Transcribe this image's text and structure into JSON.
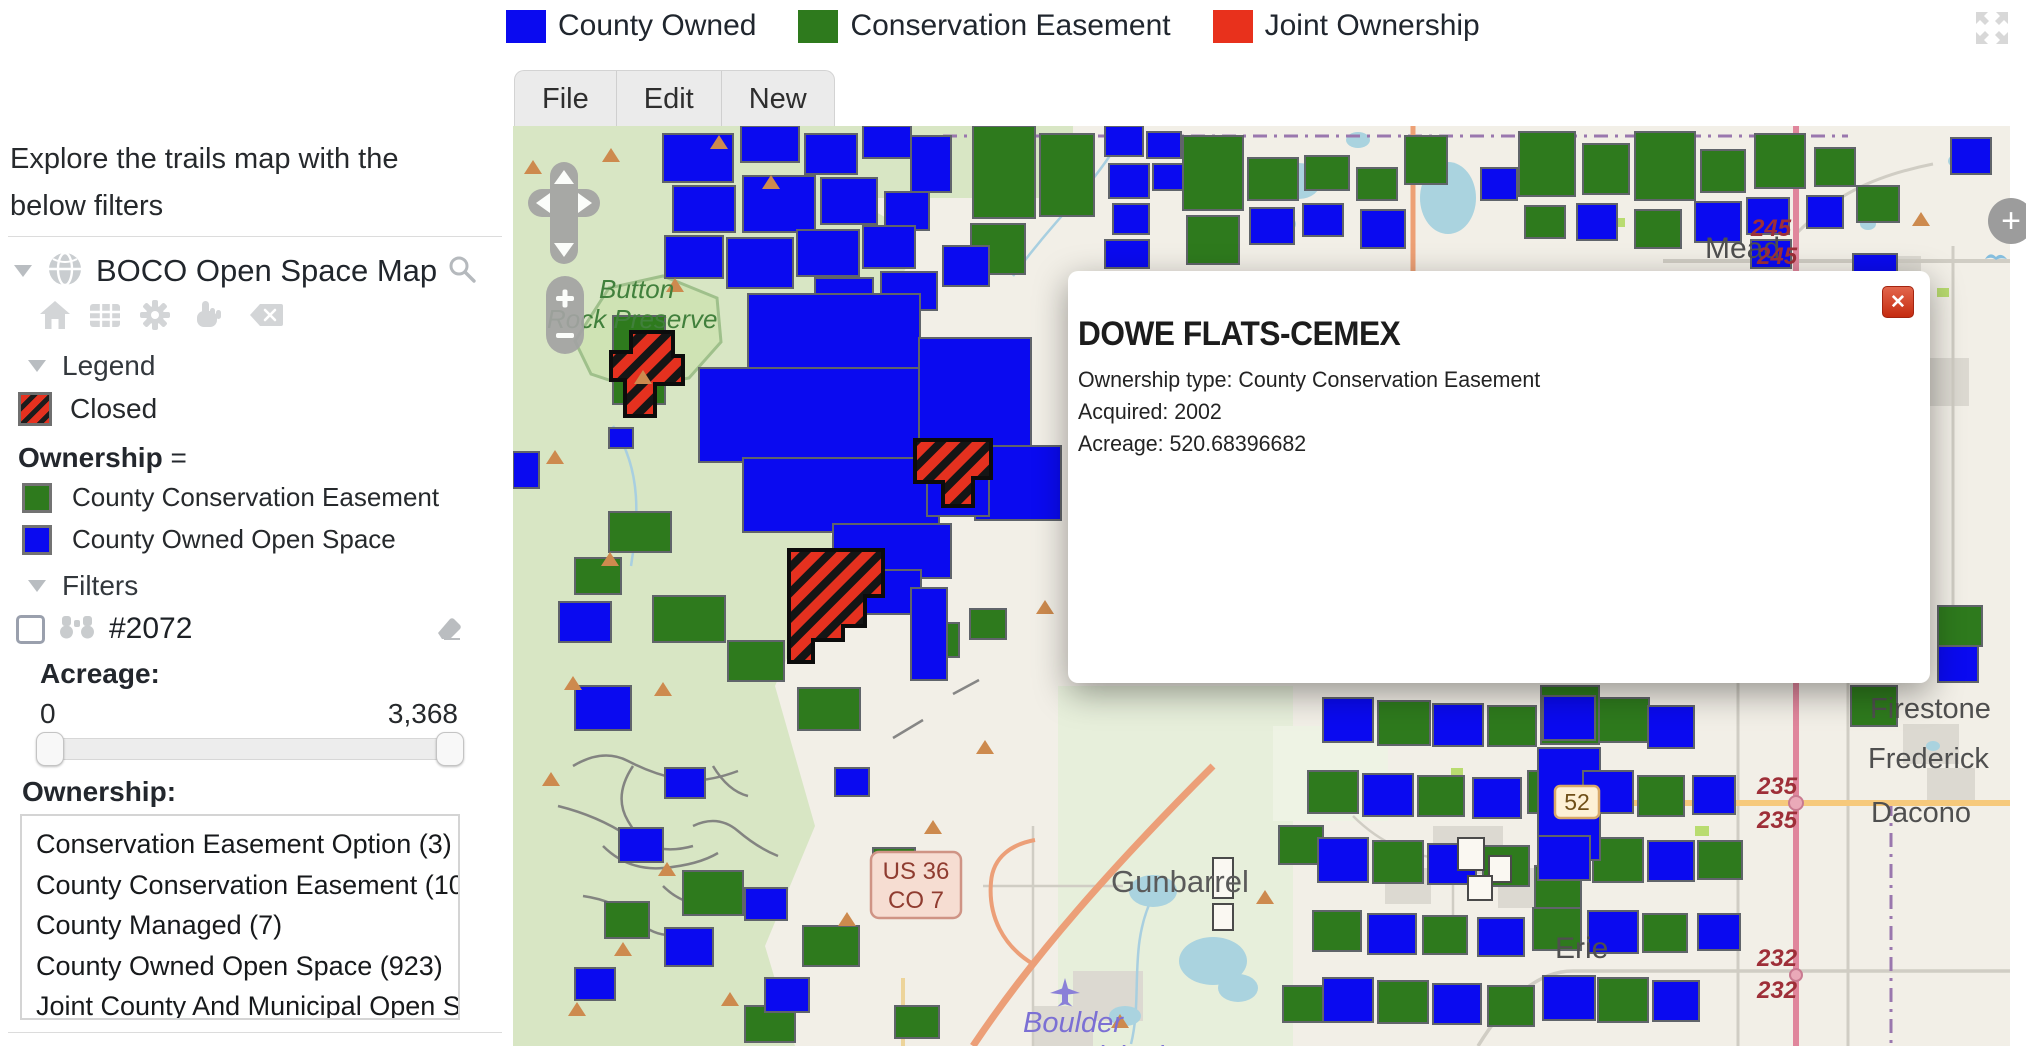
{
  "top_legend": {
    "items": [
      {
        "label": "County Owned",
        "color": "#0a0af0"
      },
      {
        "label": "Conservation Easement",
        "color": "#2e7a1d"
      },
      {
        "label": "Joint Ownership",
        "color": "#e8311c"
      }
    ]
  },
  "menu_tabs": [
    {
      "label": "File"
    },
    {
      "label": "Edit"
    },
    {
      "label": "New"
    }
  ],
  "sidebar": {
    "intro_line1": "Explore the trails map with the",
    "intro_line2": "below filters",
    "map_title": "BOCO Open Space Map",
    "legend": {
      "header": "Legend",
      "closed_label": "Closed",
      "ownership_header": "Ownership",
      "ownership_eq": "=",
      "entries": [
        {
          "label": "County Conservation Easement",
          "color": "#2e7a1d"
        },
        {
          "label": "County Owned Open Space",
          "color": "#0a0af0"
        }
      ]
    },
    "filters": {
      "header": "Filters",
      "filter_tag": "#2072",
      "acreage_label": "Acreage:",
      "acreage_min": "0",
      "acreage_max": "3,368",
      "ownership_label": "Ownership:",
      "ownership_options": [
        "Conservation Easement Option (3)",
        "County Conservation Easement (103",
        "County Managed (7)",
        "County Owned Open Space (923)",
        "Joint County And Municipal Open Sp"
      ]
    }
  },
  "popup": {
    "title": "DOWE FLATS-CEMEX",
    "close_icon": "✕",
    "fields": [
      "Ownership type: County Conservation Easement",
      "Acquired: 2002",
      "Acreage: 520.68396682"
    ]
  },
  "map": {
    "controls": {
      "zoom_in": "+",
      "zoom_out": "−",
      "edge_plus": "+"
    },
    "labels": {
      "preserve_line1": "Button",
      "preserve_line2": "Rock Preserve",
      "mead": "Mead",
      "firestone": "Firestone",
      "frederick": "Frederick",
      "dacono": "Dacono",
      "erie": "Erie",
      "gunbarrel": "Gunbarrel",
      "airport_line1": "Boulder",
      "airport_line2": "Municipal"
    },
    "shields": {
      "r245a": "245",
      "r245b": "245",
      "r235a": "235",
      "r235b": "235",
      "r232a": "232",
      "r232b": "232",
      "r52": "52",
      "us36_line1": "US 36",
      "us36_line2": "CO 7"
    }
  }
}
